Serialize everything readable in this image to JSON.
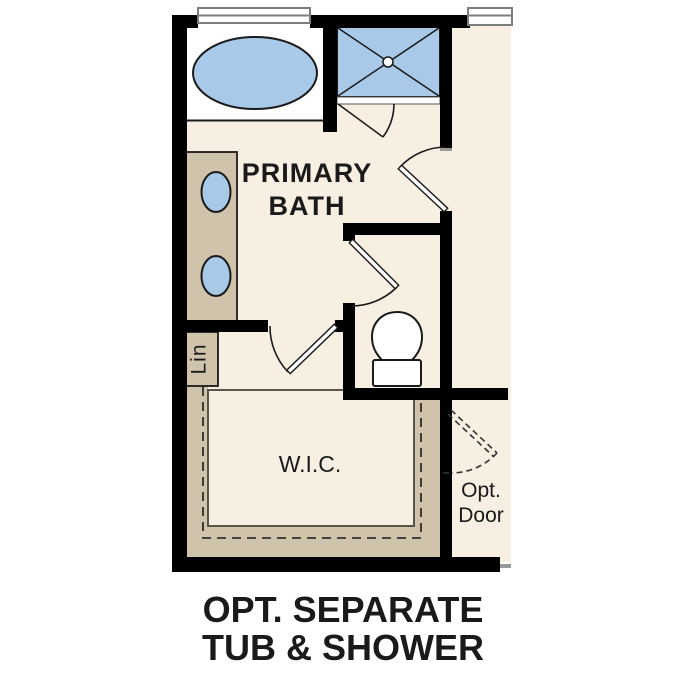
{
  "rooms": {
    "primary_bath": {
      "line1": "PRIMARY",
      "line2": "BATH"
    },
    "walk_in_closet": {
      "label": "W.I.C."
    },
    "linen_closet": {
      "label": "Lin"
    },
    "optional_door": {
      "line1": "Opt.",
      "line2": "Door"
    }
  },
  "caption": {
    "line1": "OPT. SEPARATE",
    "line2": "TUB & SHOWER"
  },
  "fixtures": [
    "bathtub",
    "shower",
    "double-sink-vanity",
    "toilet",
    "linen-closet",
    "window",
    "door-swing"
  ],
  "colors": {
    "floor": "#f6efe2",
    "casework": "#cfc3ab",
    "fixture_blue": "#a9c9e9",
    "wall": "#000000",
    "line": "#1a1a1a",
    "window_frame": "#7d7d7d",
    "floor_outline": "#5a5347",
    "text": "#1a1a1a",
    "tick": "#9a9a9a"
  }
}
